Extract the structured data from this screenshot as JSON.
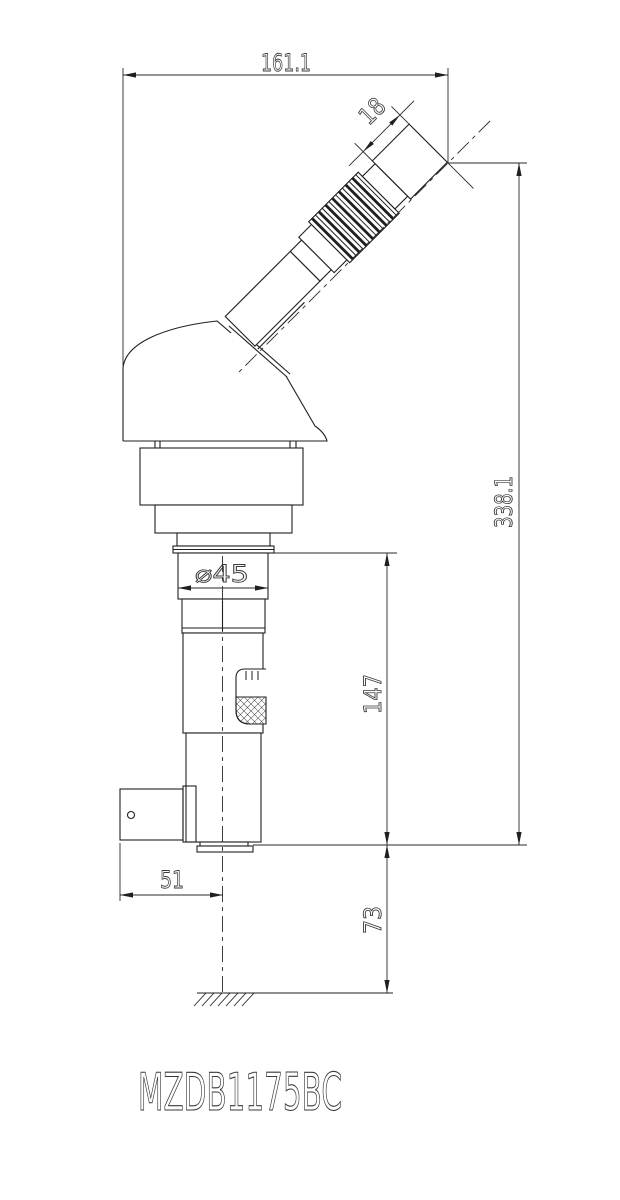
{
  "drawing": {
    "title": "MZDB1175BC",
    "dimensions": {
      "overall_width": "161.1",
      "eyepiece_end": "18",
      "overall_height": "338.1",
      "lower_body_height": "147",
      "working_distance": "73",
      "bracket_offset": "51",
      "tube_diameter": "⌀45"
    },
    "colors": {
      "line": "#1f1f1f",
      "background": "#ffffff",
      "text": "#3a3a3a"
    }
  }
}
